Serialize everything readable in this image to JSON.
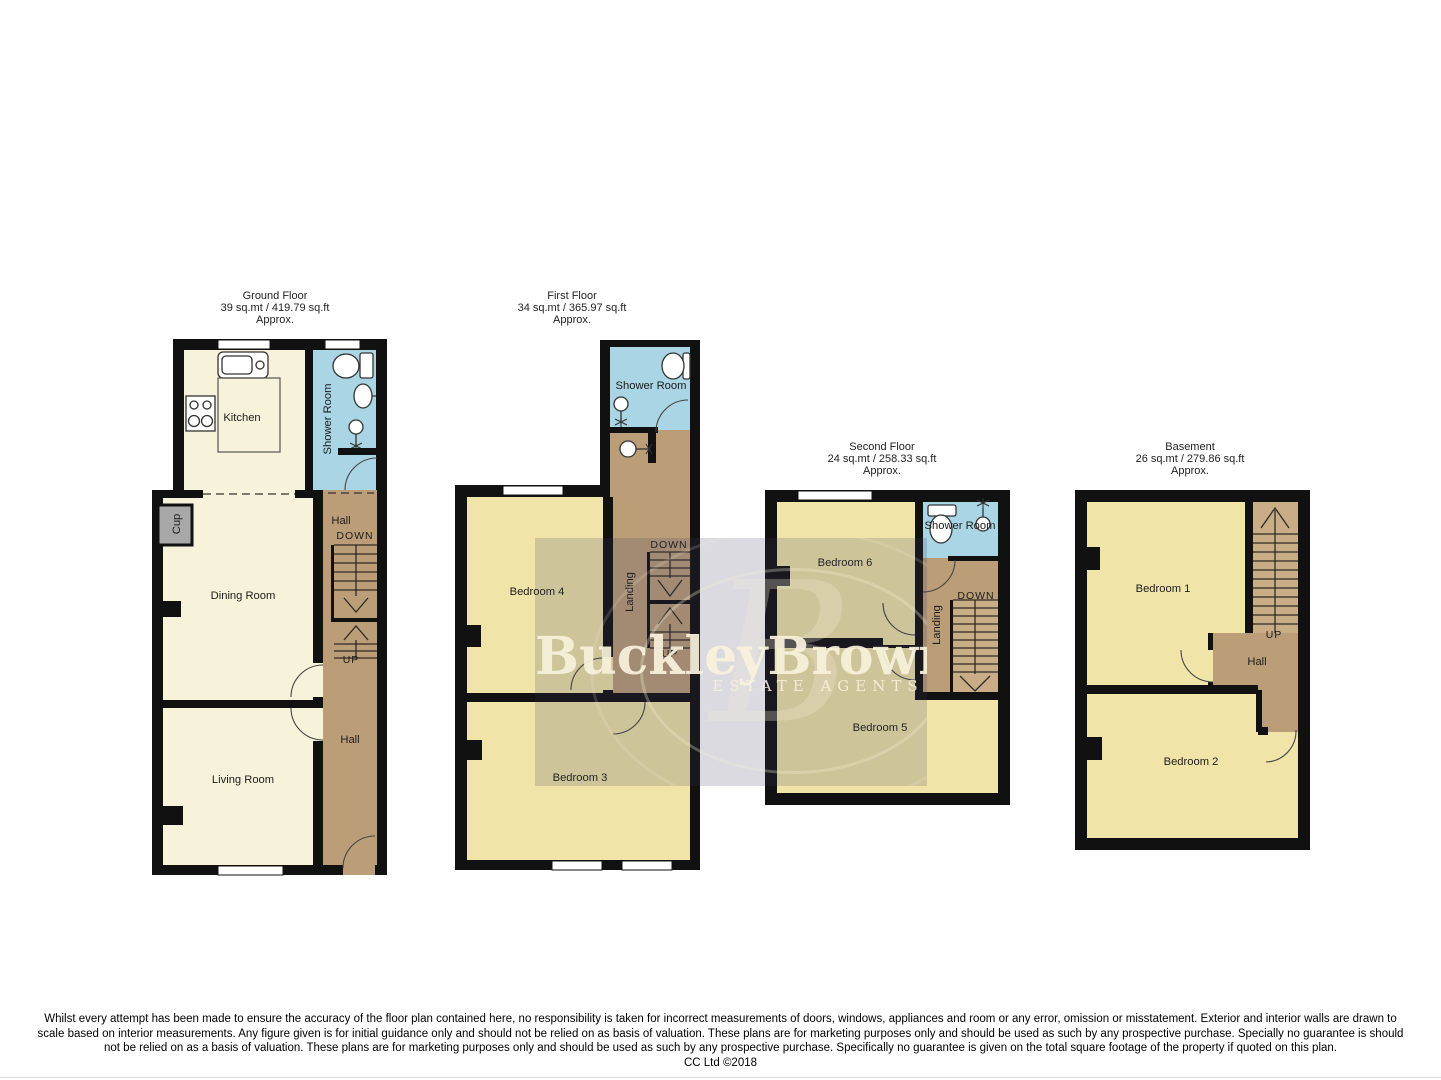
{
  "watermark": {
    "brand": "BuckleyBrown",
    "tagline": "ESTATE AGENTS"
  },
  "colors": {
    "wall": "#111111",
    "room_cream": "#f7f2da",
    "room_yellow": "#f1e4a8",
    "hall_brown": "#bb9e78",
    "stair_brown": "#c9ad87",
    "shower_blue": "#a9d5e4",
    "cupboard_grey": "#a8a8a8"
  },
  "floors": {
    "ground": {
      "title": "Ground Floor",
      "area": "39 sq.mt / 419.79 sq.ft",
      "approx": "Approx.",
      "labels": {
        "kitchen": "Kitchen",
        "shower_room": "Shower Room",
        "cup": "Cup",
        "hall_upper": "Hall",
        "down": "DOWN",
        "up": "UP",
        "dining_room": "Dining Room",
        "hall": "Hall",
        "living_room": "Living Room"
      }
    },
    "first": {
      "title": "First Floor",
      "area": "34 sq.mt / 365.97 sq.ft",
      "approx": "Approx.",
      "labels": {
        "shower_room": "Shower Room",
        "bedroom4": "Bedroom 4",
        "landing": "Landing",
        "down": "DOWN",
        "up": "UP",
        "bedroom3": "Bedroom 3"
      }
    },
    "second": {
      "title": "Second Floor",
      "area": "24 sq.mt / 258.33 sq.ft",
      "approx": "Approx.",
      "labels": {
        "bedroom6": "Bedroom 6",
        "shower_room": "Shower Room",
        "landing": "Landing",
        "down": "DOWN",
        "bedroom5": "Bedroom 5"
      }
    },
    "basement": {
      "title": "Basement",
      "area": "26 sq.mt / 279.86 sq.ft",
      "approx": "Approx.",
      "labels": {
        "bedroom1": "Bedroom 1",
        "up": "UP",
        "hall": "Hall",
        "bedroom2": "Bedroom 2"
      }
    }
  },
  "disclaimer": {
    "lines": [
      "Whilst every attempt has been made to ensure the accuracy of the floor plan contained here, no responsibility is taken for incorrect measurements of doors, windows, appliances and room or any error, omission or misstatement. Exterior and interior walls are drawn to",
      "scale based on interior measurements. Any figure given is for initial guidance only and should not be relied on as basis of valuation. These plans are for marketing purposes only and should be used as such by any prospective purchase. Specially no guarantee is should",
      "not be relied on as a basis of valuation. These plans are for marketing purposes only and should be used as such by any prospective purchase. Specifically no guarantee is given on the total square footage of the property if quoted on this plan."
    ],
    "copyright": "CC Ltd ©2018"
  }
}
